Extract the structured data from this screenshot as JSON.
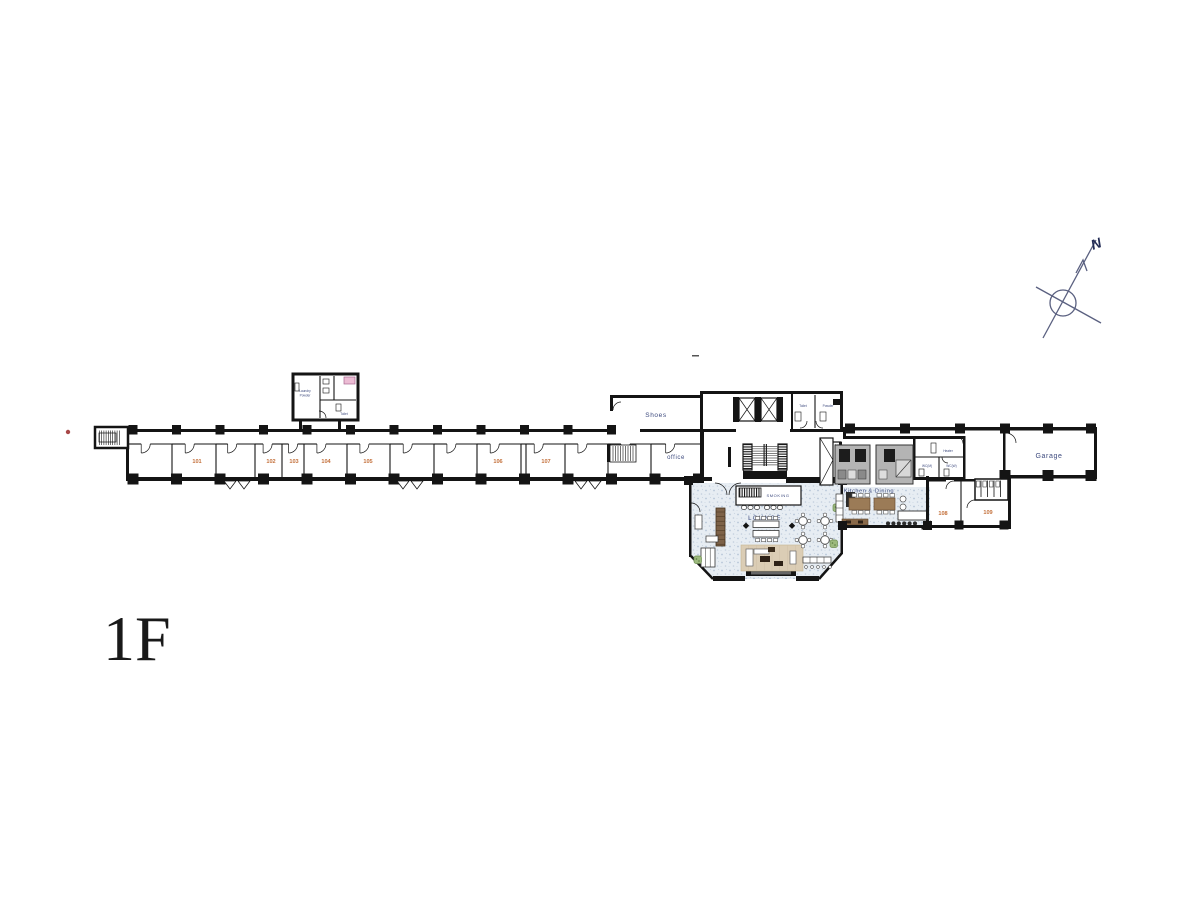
{
  "floor_label": "1F",
  "compass": {
    "north": "N"
  },
  "rooms": {
    "numbers": [
      "101",
      "102",
      "103",
      "104",
      "105",
      "106",
      "107",
      "108",
      "109"
    ]
  },
  "areas": {
    "shoes": "Shoes",
    "office": "office",
    "garage": "Garage",
    "kitchen": "Kitchen & Dining",
    "lounge": "LOUNGE",
    "smoking": "SMOKING"
  },
  "small_rooms": {
    "laundry": "Laundry",
    "powder": "Powder",
    "toilet": "Toilet",
    "core_toilet": "Toilet",
    "core_powder": "Powder",
    "heater": "Heater",
    "wc_m": "WC(M)",
    "wc_w": "WC(W)"
  },
  "colors": {
    "wall": "#141414",
    "room_number": "#c4713c",
    "area_label": "#3d4a7e",
    "lounge_floor": "#e7edf3",
    "rug": "#dbcdb5",
    "kitchen_island": "#b4b4b4",
    "plant": "#9cb97d",
    "washer_pink": "#ecbcd4",
    "compass": "#5a6080"
  }
}
